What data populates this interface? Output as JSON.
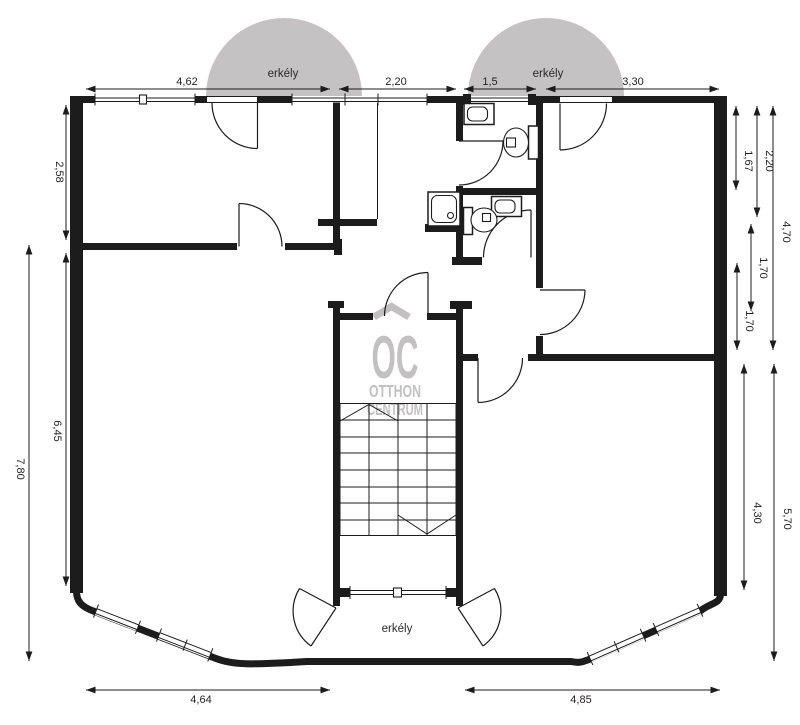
{
  "plan": {
    "type": "apartment-floor-plan",
    "balconies": {
      "top_left": "erkély",
      "top_right": "erkély",
      "bottom": "erkély"
    },
    "dimensions": {
      "top": [
        {
          "label": "4,62"
        },
        {
          "label": "2,20"
        },
        {
          "label": "1,5"
        },
        {
          "label": "3,30"
        }
      ],
      "left": [
        {
          "label": "2,58"
        },
        {
          "label": "6,45"
        },
        {
          "label": "7,80"
        }
      ],
      "right": [
        {
          "label": "1,67"
        },
        {
          "label": "2,20"
        },
        {
          "label": "4,70"
        },
        {
          "label": "1,70"
        },
        {
          "label": "1,70"
        },
        {
          "label": "4,30"
        },
        {
          "label": "5,70"
        }
      ],
      "bottom": [
        {
          "label": "4,64"
        },
        {
          "label": "4,85"
        }
      ]
    },
    "logo": {
      "monogram": "OC",
      "word1": "OTTHON",
      "word2": "CENTRUM"
    },
    "colors": {
      "wall": "#1c1c1c",
      "balcony_fill": "#c5c2c4",
      "logo_gray": "#c2c0c1",
      "dim_text": "#231f20"
    }
  }
}
